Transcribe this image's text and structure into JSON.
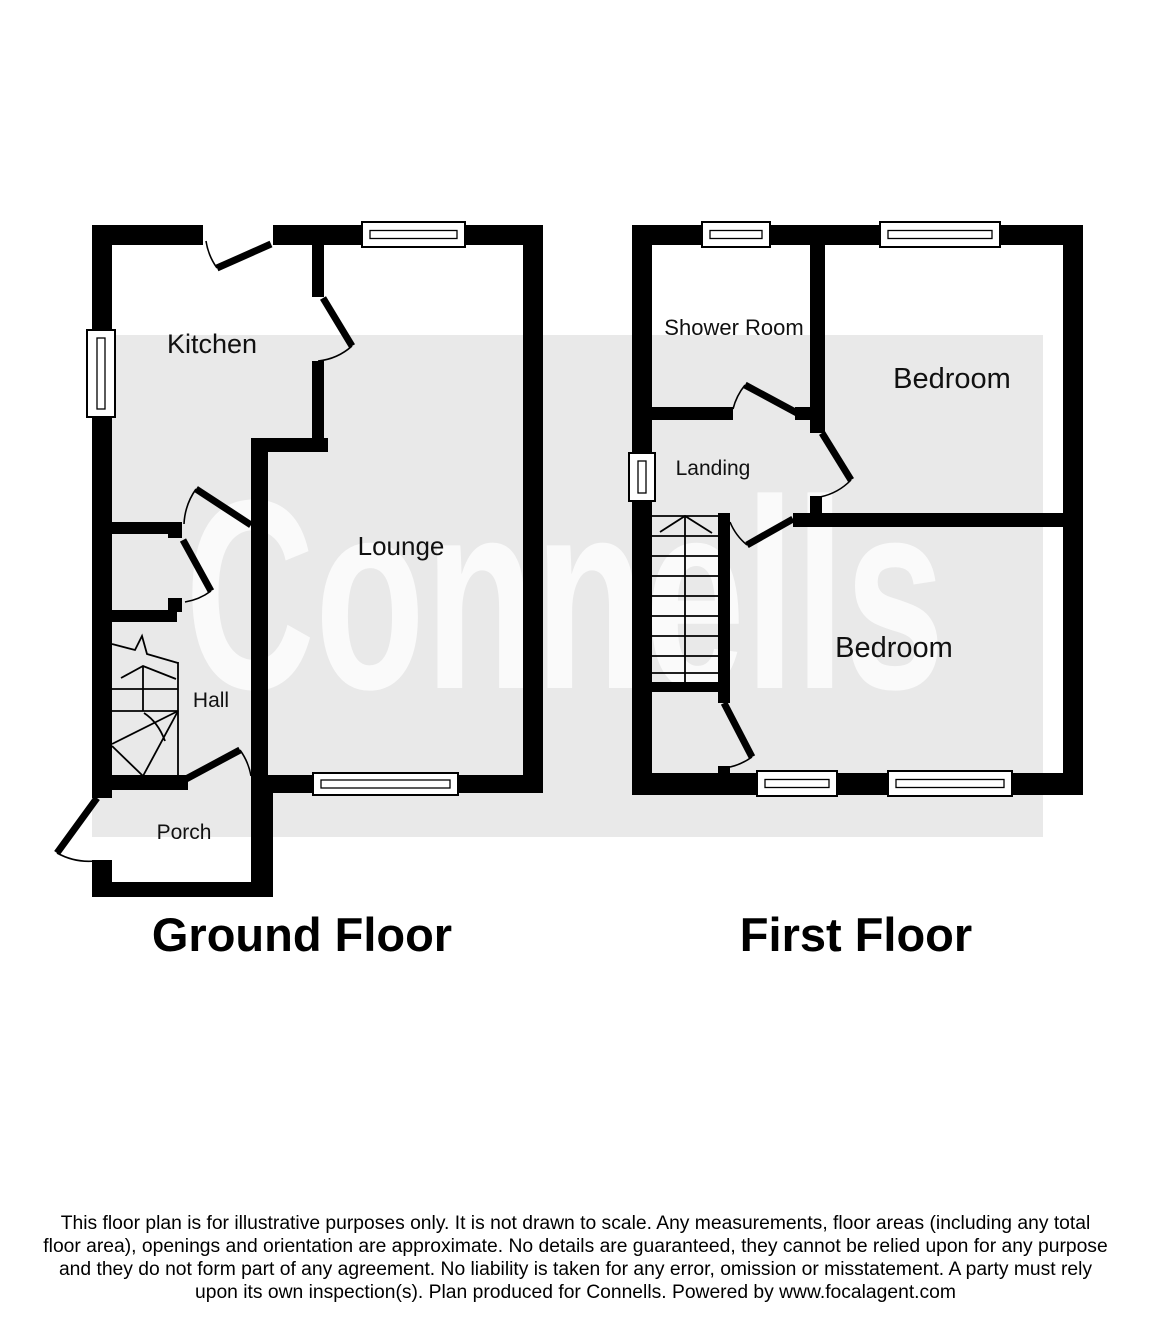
{
  "watermark_text": "Connells",
  "colors": {
    "wall": "#000000",
    "band": "#e9e9e9",
    "watermark": "#fafafa",
    "label": "#111111"
  },
  "ground_floor": {
    "title": "Ground Floor",
    "rooms": {
      "kitchen": "Kitchen",
      "lounge": "Lounge",
      "hall": "Hall",
      "porch": "Porch"
    }
  },
  "first_floor": {
    "title": "First Floor",
    "rooms": {
      "shower_room": "Shower Room",
      "bedroom_front": "Bedroom",
      "landing": "Landing",
      "bedroom_back": "Bedroom"
    }
  },
  "footer": {
    "disclaimer": "This floor plan is for illustrative purposes only. It is not drawn to scale. Any measurements, floor areas (including any total floor area), openings and orientation are approximate. No details are guaranteed, they cannot be relied upon for any purpose and they do not form part of any agreement. No liability is taken for any error, omission or misstatement. A party must rely upon its own inspection(s). Plan produced for Connells. Powered by www.focalagent.com"
  }
}
